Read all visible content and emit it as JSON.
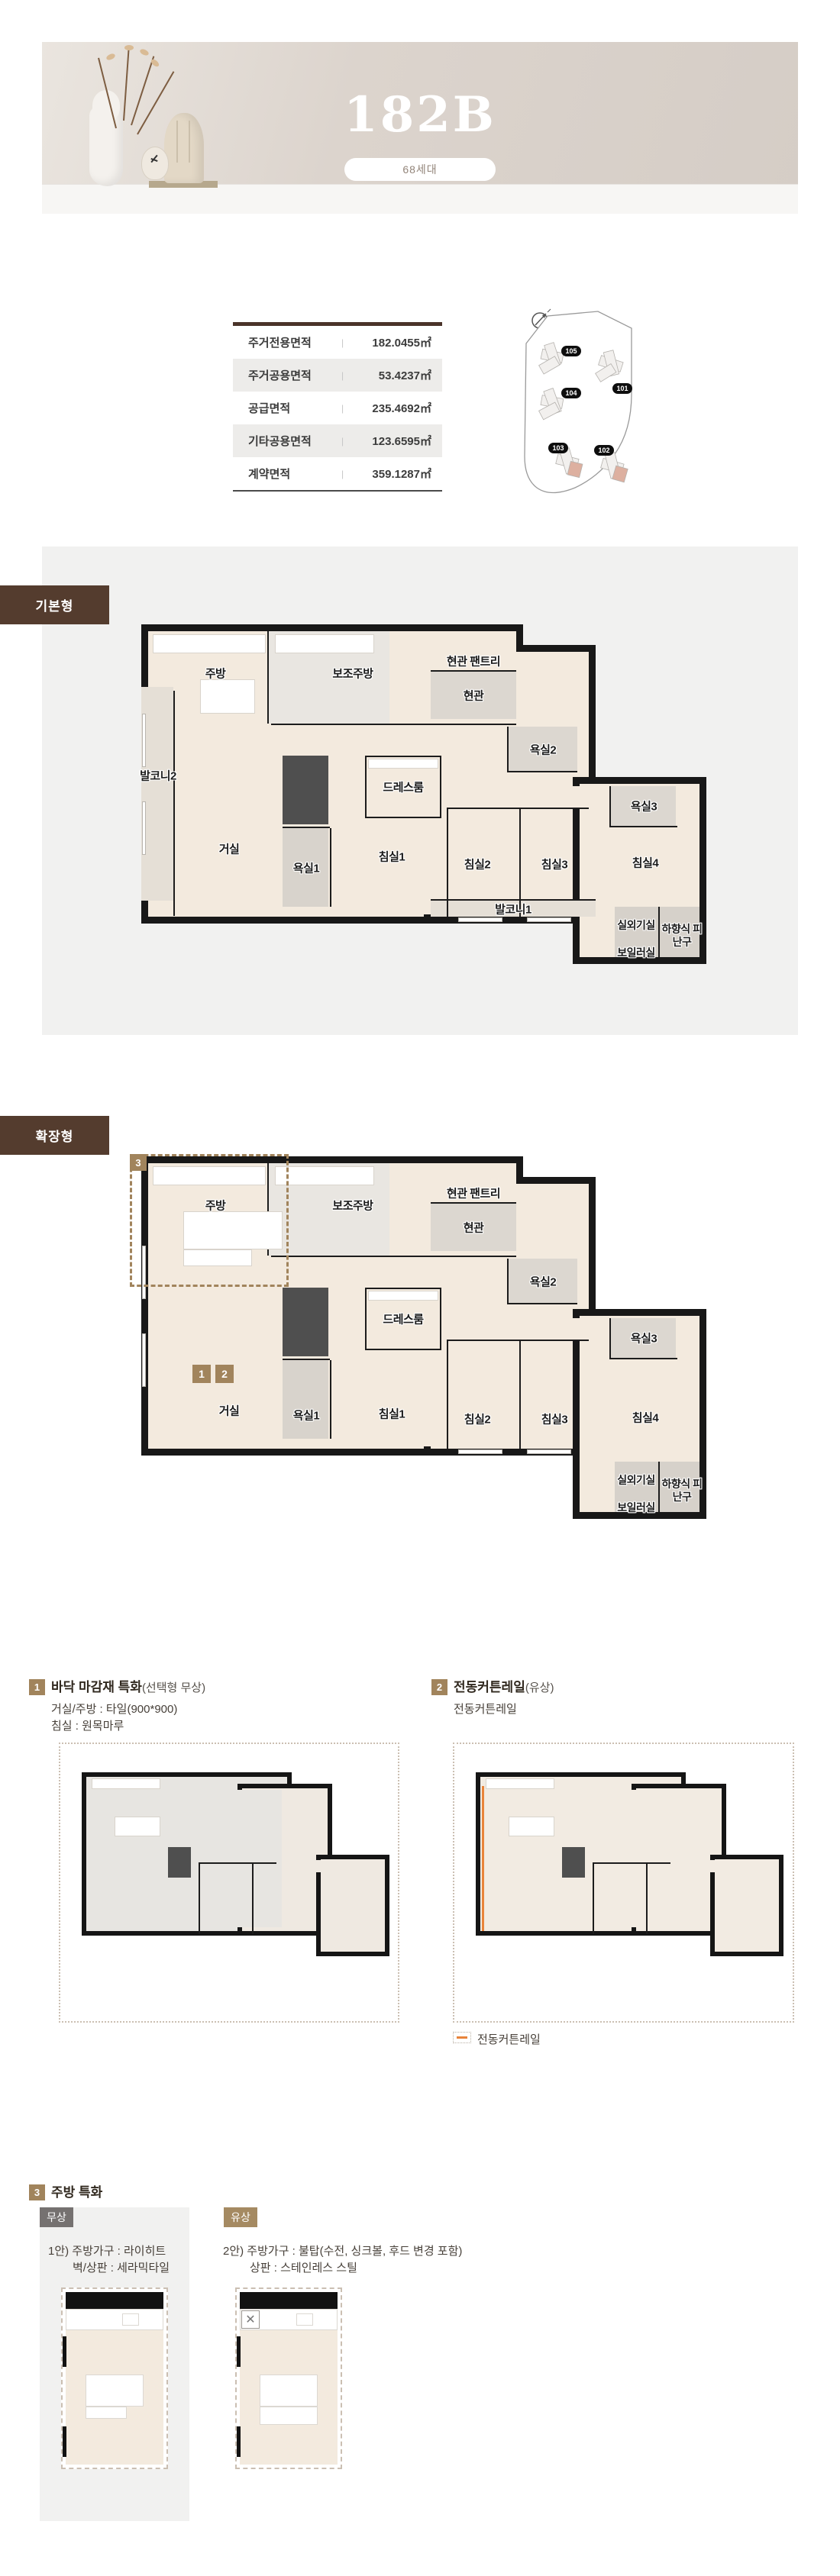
{
  "hero": {
    "title": "182B",
    "badge": "68세대"
  },
  "area_table": {
    "rows": [
      {
        "label": "주거전용면적",
        "value": "182.0455㎡"
      },
      {
        "label": "주거공용면적",
        "value": "53.4237㎡"
      },
      {
        "label": "공급면적",
        "value": "235.4692㎡"
      },
      {
        "label": "기타공용면적",
        "value": "123.6595㎡"
      },
      {
        "label": "계약면적",
        "value": "359.1287㎡"
      }
    ]
  },
  "site_map": {
    "buildings": [
      {
        "id": "105"
      },
      {
        "id": "101"
      },
      {
        "id": "104"
      },
      {
        "id": "103"
      },
      {
        "id": "102"
      }
    ]
  },
  "plan_basic": {
    "tab": "기본형",
    "rooms": {
      "kitchen": "주방",
      "aux_kitchen": "보조주방",
      "entry_pantry": "현관 팬트리",
      "entry": "현관",
      "balcony2": "발코니2",
      "living": "거실",
      "bath1": "욕실1",
      "dressroom": "드레스룸",
      "bed1": "침실1",
      "bath2": "욕실2",
      "bed2": "침실2",
      "bed3": "침실3",
      "bed4": "침실4",
      "bath3": "욕실3",
      "balcony1": "발코니1",
      "outdoor_unit": "실외기실",
      "escape_hatch": "하향식 피난구",
      "boiler": "보일러실"
    }
  },
  "plan_ext": {
    "tab": "확장형",
    "marker1": "1",
    "marker2": "2",
    "marker3": "3",
    "rooms": {
      "kitchen": "주방",
      "aux_kitchen": "보조주방",
      "entry_pantry": "현관 팬트리",
      "entry": "현관",
      "living": "거실",
      "bath1": "욕실1",
      "dressroom": "드레스룸",
      "bed1": "침실1",
      "bath2": "욕실2",
      "bed2": "침실2",
      "bed3": "침실3",
      "bed4": "침실4",
      "bath3": "욕실3",
      "outdoor_unit": "실외기실",
      "escape_hatch": "하향식 피난구",
      "boiler": "보일러실"
    }
  },
  "feature1": {
    "no": "1",
    "title": "바닥 마감재 특화",
    "suffix": "(선택형 무상)",
    "line1": "거실/주방 : 타일(900*900)",
    "line2": "침실 : 원목마루"
  },
  "feature2": {
    "no": "2",
    "title": "전동커튼레일",
    "suffix": "(유상)",
    "line1": "전동커튼레일",
    "legend": "전동커튼레일"
  },
  "feature3": {
    "no": "3",
    "title": "주방 특화",
    "option_free": {
      "badge": "무상",
      "line1": "1안) 주방가구 : 라이히트",
      "line2": "벽/상판 : 세라믹타일"
    },
    "option_paid": {
      "badge": "유상",
      "line1": "2안) 주방가구 : 불탑(수전, 싱크볼, 후드 변경 포함)",
      "line2": "상판 : 스테인레스 스틸"
    }
  }
}
